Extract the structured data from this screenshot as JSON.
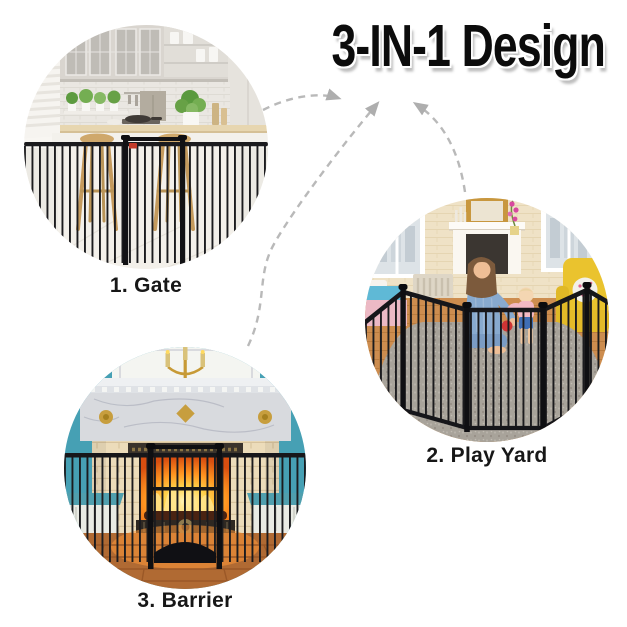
{
  "title": "3-IN-1 Design",
  "features": [
    {
      "id": "gate",
      "label": "1. Gate"
    },
    {
      "id": "play-yard",
      "label": "2. Play Yard"
    },
    {
      "id": "barrier",
      "label": "3. Barrier"
    }
  ],
  "icons": [
    {
      "name": "dashed-arrow",
      "count": 3,
      "meaning": "each usage mode points to the 3-in-1 title"
    }
  ],
  "colors": {
    "background": "#ffffff",
    "title_text": "#0c0c0c",
    "label_text": "#171717",
    "arrow_gray": "#b9b9b9",
    "product_metal_black": "#17171a",
    "gate_latch_red": "#c23b2a",
    "fireplace_wall_teal": "#46a0b4",
    "fire_orange": "#ff8a1a",
    "armchair_yellow": "#eac32e",
    "kitchen_wood": "#e7d6b0",
    "rug_gray": "#a8a39a"
  }
}
